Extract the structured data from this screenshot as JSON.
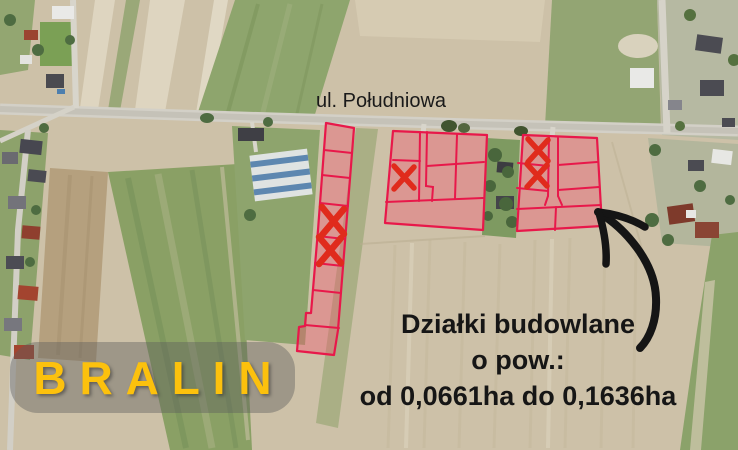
{
  "scene": {
    "street_label": "ul. Południowa",
    "town_banner": {
      "label": "BRALIN"
    },
    "info": {
      "line1": "Działki budowlane",
      "line2": "o pow.:",
      "line3": "od 0,0661ha do 0,1636ha"
    },
    "plot_groups": [
      {
        "name": "left-strip",
        "plots": 8,
        "sold_marked": 2
      },
      {
        "name": "middle-block",
        "plots": 7,
        "sold_marked": 1
      },
      {
        "name": "right-block",
        "plots": 8,
        "sold_marked": 2
      }
    ],
    "colors": {
      "plot_outline": "#e8184a",
      "plot_fill": "rgba(242,85,110,0.38)",
      "sold_x": "#e02b1c",
      "banner_bg": "rgba(92,92,92,0.42)",
      "banner_text": "#fcc10d",
      "info_text": "#161616",
      "arrow": "#151515"
    }
  }
}
